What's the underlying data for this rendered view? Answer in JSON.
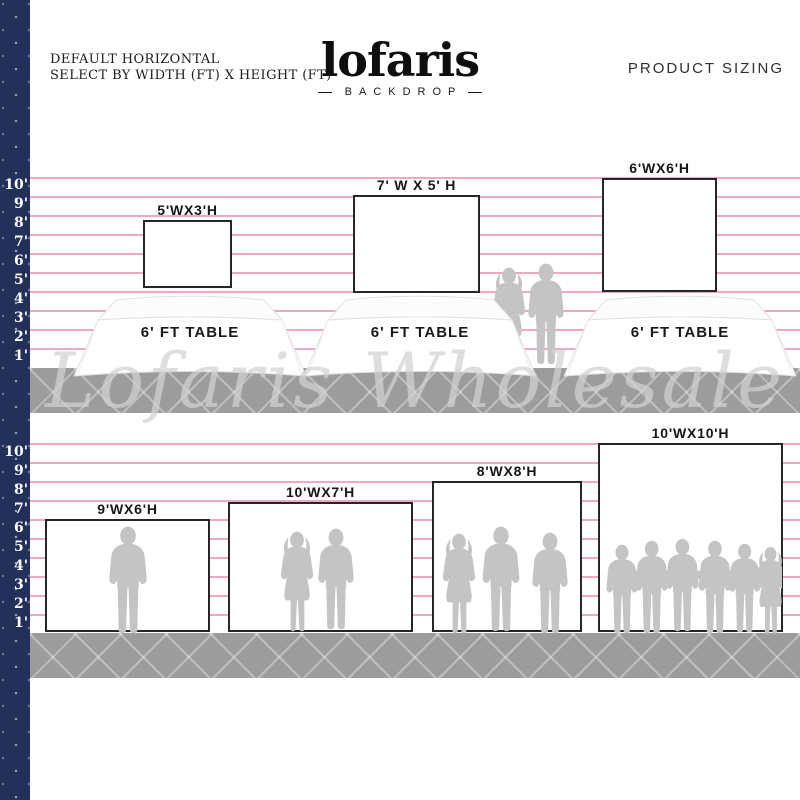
{
  "page": {
    "title_line1": "DEFAULT HORIZONTAL",
    "title_line2": "SELECT BY WIDTH (FT) X HEIGHT (FT)",
    "brand": {
      "name": "lofaris",
      "sub": "BACKDROP"
    },
    "corner_label": "PRODUCT SIZING",
    "watermark": "Lofaris Wholesale"
  },
  "colors": {
    "navy_strip": "#22305a",
    "ruled_line_pink": "#e79cb0",
    "floor_gray": "#9c9c9c",
    "silhouette_gray": "#c4c4c4",
    "watermark_gray": "#d2d2d2",
    "backdrop_border": "#262626"
  },
  "scale": {
    "unit": "ft",
    "numbers": [
      "10'",
      "9'",
      "8'",
      "7'",
      "6'",
      "5'",
      "4'",
      "3'",
      "2'",
      "1'"
    ]
  },
  "top_row": {
    "table_label": "6' FT TABLE",
    "backdrops": [
      {
        "label": "5'WX3'H"
      },
      {
        "label": "7' W X 5' H"
      },
      {
        "label": "6'WX6'H"
      }
    ],
    "people_between_tables": 2
  },
  "bottom_row": {
    "backdrops": [
      {
        "label": "9'WX6'H",
        "people": 1
      },
      {
        "label": "10'WX7'H",
        "people": 2
      },
      {
        "label": "8'WX8'H",
        "people": 3
      },
      {
        "label": "10'WX10'H",
        "people": 6
      }
    ]
  }
}
